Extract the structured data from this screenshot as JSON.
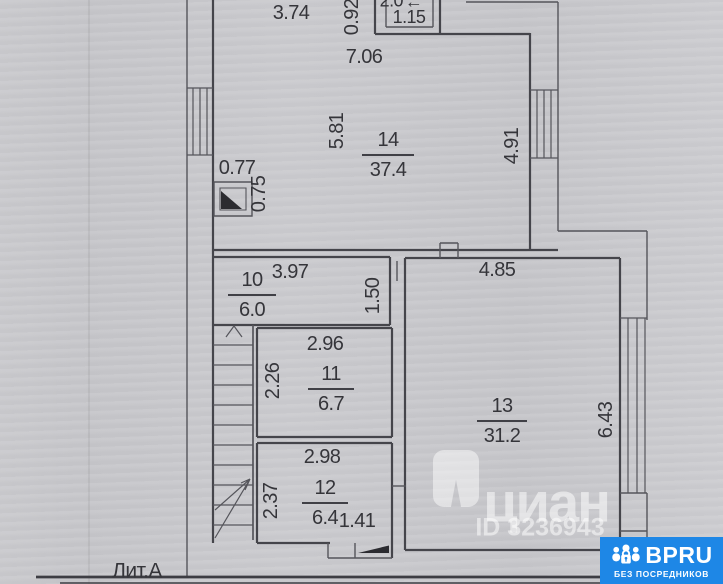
{
  "plan": {
    "litera": "Лит.А",
    "rooms": {
      "r14": {
        "number": "14",
        "area": "37.4"
      },
      "r10": {
        "number": "10",
        "area": "6.0"
      },
      "r11": {
        "number": "11",
        "area": "6.7"
      },
      "r12": {
        "number": "12",
        "area": "6.4"
      },
      "r13": {
        "number": "13",
        "area": "31.2"
      },
      "balcony": {
        "area": "2.0",
        "width": "1.15",
        "arrow_icon": "←"
      }
    },
    "dimensions": {
      "top_segment": "3.74",
      "top_small": "0.92",
      "room14_width": "7.06",
      "room14_depth_left": "5.81",
      "room14_depth_right": "4.91",
      "niche_width": "0.77",
      "niche_depth": "0.75",
      "room10_width": "3.97",
      "room10_depth": "1.50",
      "room13_width": "4.85",
      "room13_depth": "6.43",
      "room11_width": "2.96",
      "room11_depth": "2.26",
      "room12_width": "2.98",
      "room12_depth": "2.37",
      "entry_width": "1.41"
    }
  },
  "watermark": {
    "brand": "циан",
    "id_label": "ID 3236943"
  },
  "badge": {
    "brand": "BPRU",
    "tagline": "БЕЗ ПОСРЕДНИКОВ"
  },
  "colors": {
    "badge_blue": "#1e87e6",
    "paper": "#c7c7cb",
    "ink": "#35353a",
    "wall": "#45454b"
  }
}
